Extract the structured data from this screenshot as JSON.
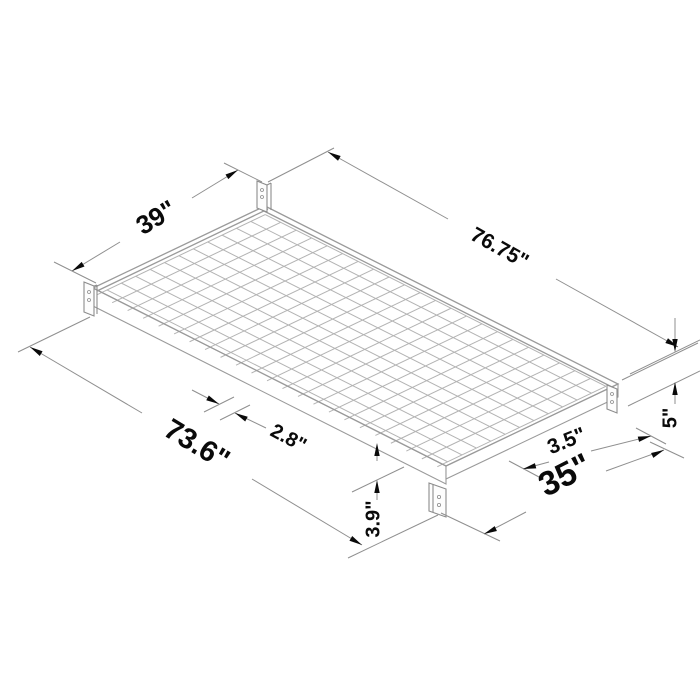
{
  "dimensions": {
    "head_width": "39\"",
    "overall_length": "76.75\"",
    "deck_length": "73.6\"",
    "grid_spacing": "2.8\"",
    "edge_offset": "3.5\"",
    "foot_width": "35\"",
    "side_bracket_height": "5\"",
    "front_leg_height": "3.9\""
  },
  "colors": {
    "background": "#ffffff",
    "mesh_line": "#b3b3b3",
    "frame_line": "#9a9a9a",
    "bracket_line": "#8c8c8c",
    "dimension_line": "#8f8f8f",
    "annotation": "#0a0a0a"
  }
}
